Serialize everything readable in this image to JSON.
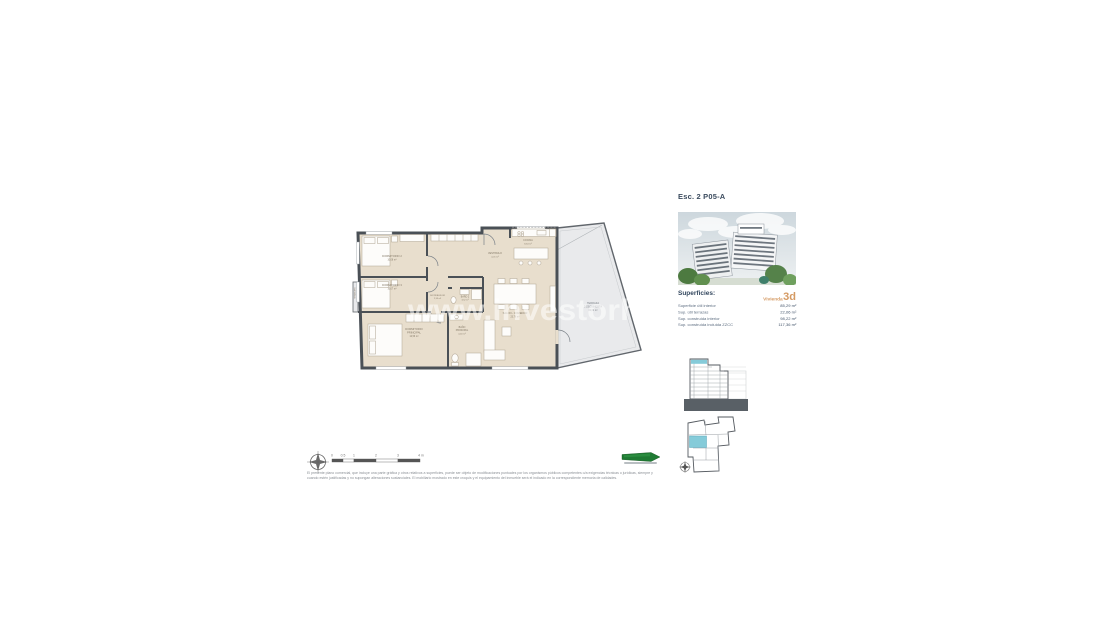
{
  "watermark": "www.investorh",
  "plan": {
    "rooms": [
      {
        "lines": [
          "DORMITORIO 2",
          "10,08 m²"
        ]
      },
      {
        "lines": [
          "DORMITORIO 3",
          "10,07 m²"
        ]
      },
      {
        "lines": [
          "DORMITORIO",
          "PRINCIPAL",
          "12,56 m²"
        ]
      },
      {
        "lines": [
          "BAÑO",
          "PRINCIPAL",
          "4,40 m²"
        ]
      },
      {
        "lines": [
          "BAÑO 2",
          "3,52 m²"
        ]
      },
      {
        "lines": [
          "DISTRIBUIDOR",
          "2,99 m²"
        ]
      },
      {
        "lines": [
          "VESTIBULO",
          "4,01 m²"
        ]
      },
      {
        "lines": [
          "COCINA",
          "8,64 m²"
        ]
      },
      {
        "lines": [
          "SALON - COMEDOR",
          "23,76 m²"
        ]
      },
      {
        "lines": [
          "TERRAZA",
          "DESCUBIERTA",
          "22,06 m²"
        ]
      },
      {
        "lines": [
          "TENDEDERO",
          "2,10 m²"
        ]
      }
    ]
  },
  "info": {
    "title": "Esc. 2 P05-A",
    "superficies_label": "Superficies:",
    "vivienda_label": "Vivienda",
    "vivienda_3d": "3d",
    "rows": [
      {
        "label": "Superficie útil interior",
        "value": "85,29 m²"
      },
      {
        "label": "Sup. útil terrazas",
        "value": "22,06 m²"
      },
      {
        "label": "Sup. construida interior",
        "value": "98,22 m²"
      },
      {
        "label": "Sup. construida incluida ZZCC",
        "value": "117,36 m²"
      }
    ]
  },
  "scalebar": {
    "ticks": [
      "0",
      "0.5",
      "1",
      "2",
      "3",
      "4 m"
    ]
  },
  "disclaimer": {
    "line1": "El presente plano comercial, que incluye una parte gráfica y otros relativos a superficies, puede ser objeto de modificaciones puntuales por los organismos públicos competentes o/a exigencias técnicas o jurídicas, siempre y",
    "line2": "cuando estén justificadas y no supongan alteraciones sustanciales. El mobiliario mostrado en este croquis y el equipamiento del inmueble será el indicado en la correspondiente memoria de calidades."
  },
  "colors": {
    "floor_beige": "#e8decd",
    "wall_dark": "#4a5056",
    "terrace_gray": "#e9eaec",
    "highlight_cyan": "#85cbd9",
    "accent_orange": "#d59a63",
    "navy_text": "#3b4b5e",
    "logo_green": "#1f7a33"
  }
}
